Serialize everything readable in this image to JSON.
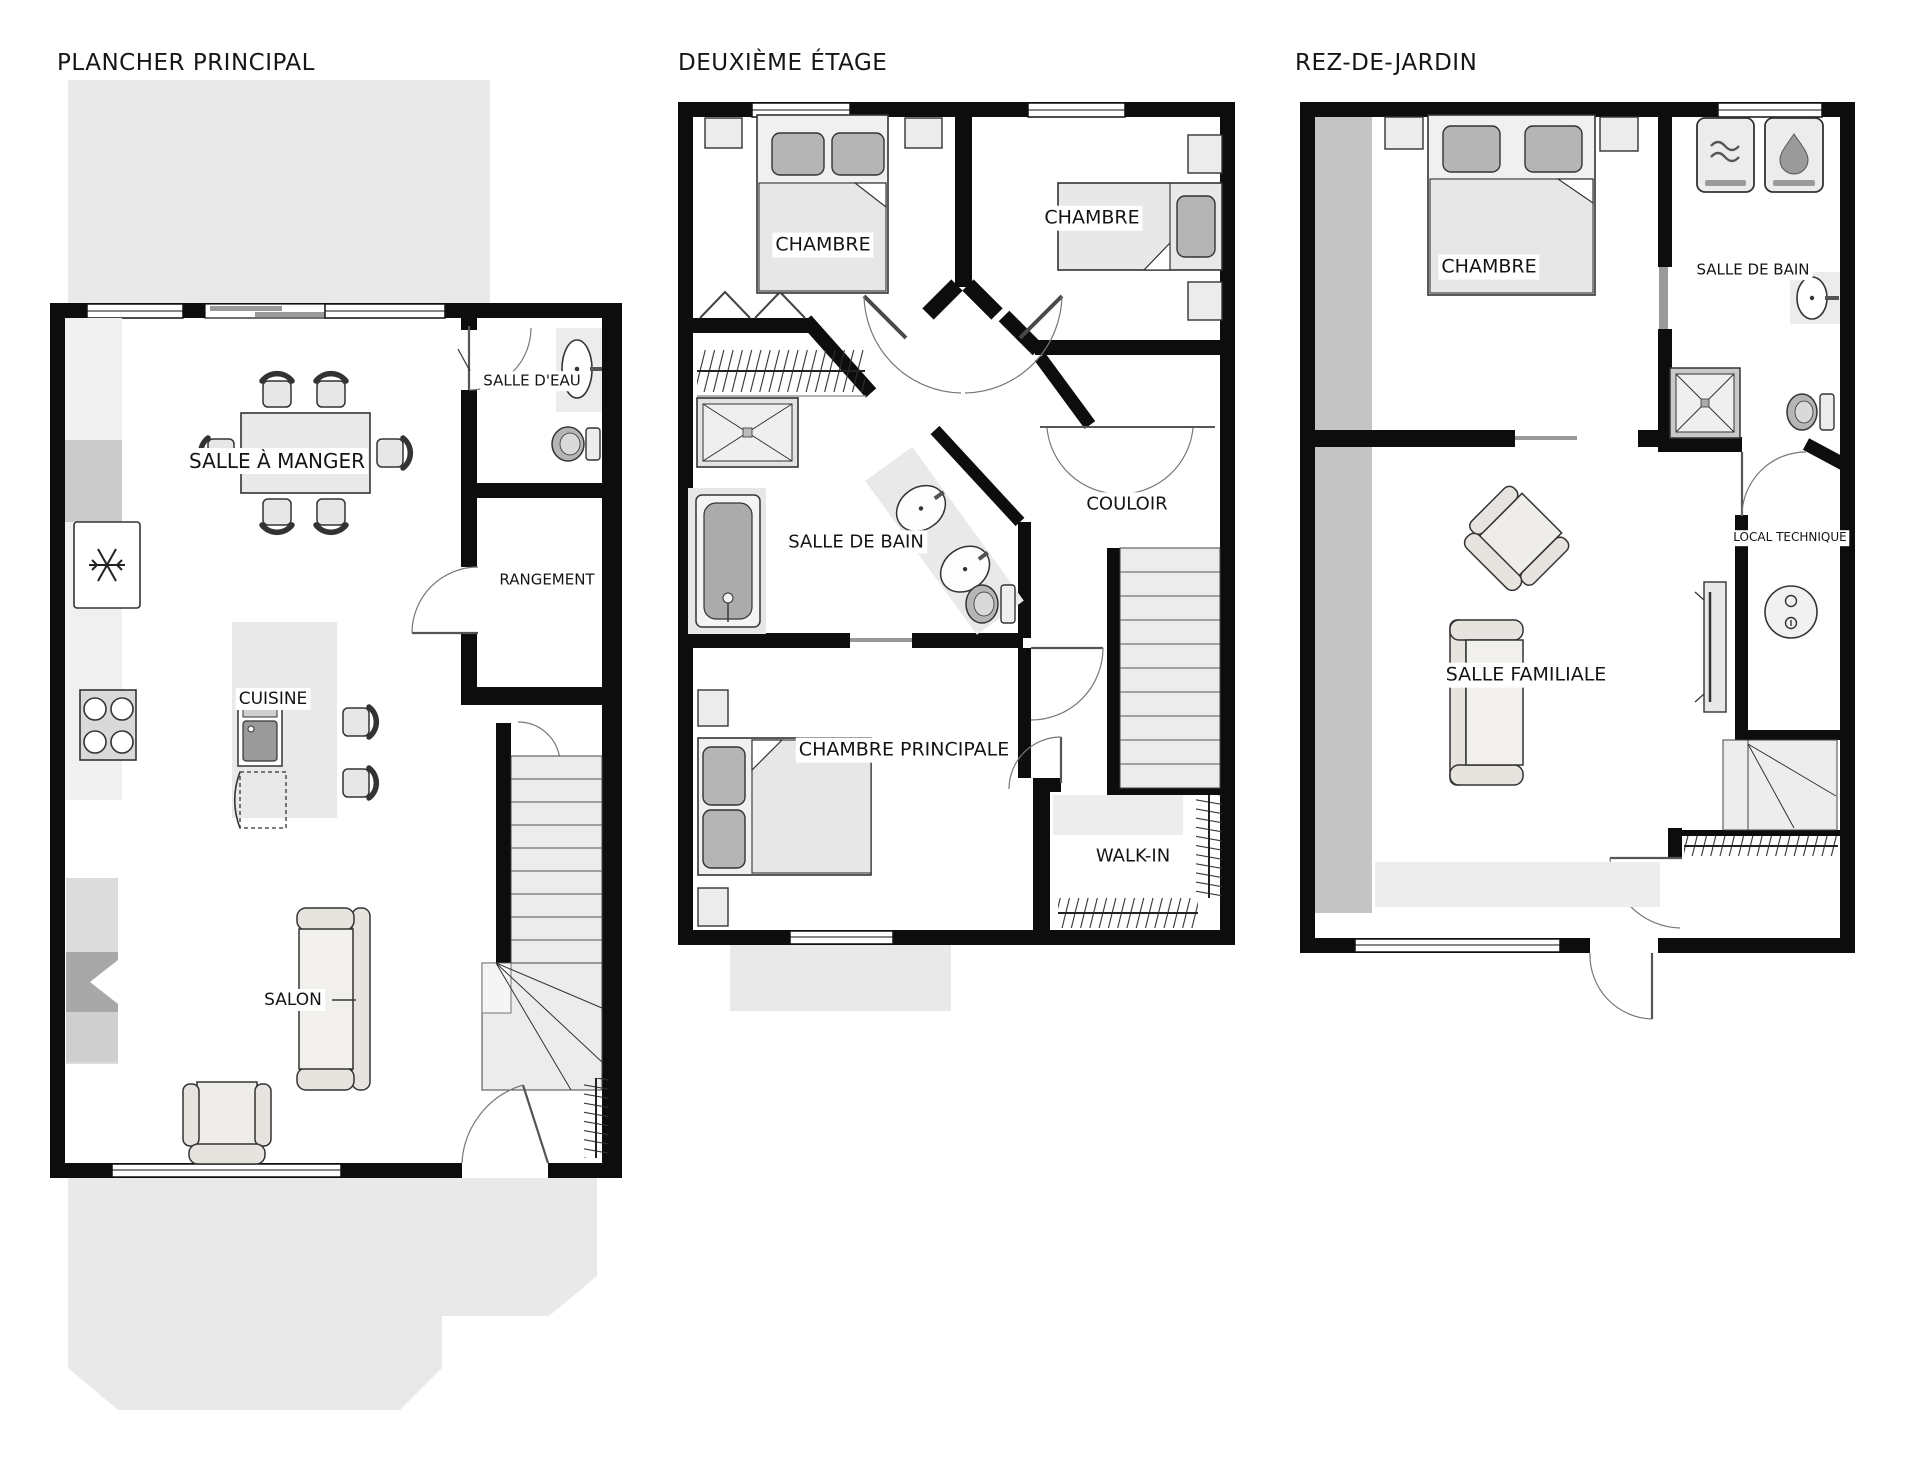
{
  "document": {
    "title": "Plans d'étage",
    "background": "#ffffff"
  },
  "colors": {
    "wall": "#0d0d0d",
    "floor": "#ffffff",
    "deck": "#e9e9e9",
    "party_wall": "#c4c4c4",
    "furniture": "#ececec",
    "soft_dark": "#b5b5b5",
    "label_bg": "#ffffff",
    "text": "#141414"
  },
  "icons": {
    "fridge": "snowflake-icon",
    "cooktop": "burners-icon",
    "kitchen_sink": "basin-icon",
    "washer": "waves-icon",
    "dryer": "droplet-icon",
    "shower": "x-cross-icon",
    "water_heater": "gauge-circles-icon"
  },
  "plans": [
    {
      "title": "PLANCHER PRINCIPAL",
      "rooms": [
        {
          "label": "SALLE À MANGER"
        },
        {
          "label": "SALLE D'EAU"
        },
        {
          "label": "RANGEMENT"
        },
        {
          "label": "CUISINE"
        },
        {
          "label": "SALON"
        }
      ]
    },
    {
      "title": "DEUXIÈME ÉTAGE",
      "rooms": [
        {
          "label": "CHAMBRE"
        },
        {
          "label": "CHAMBRE"
        },
        {
          "label": "SALLE DE BAIN"
        },
        {
          "label": "COULOIR"
        },
        {
          "label": "CHAMBRE PRINCIPALE"
        },
        {
          "label": "WALK-IN"
        }
      ]
    },
    {
      "title": "REZ-DE-JARDIN",
      "rooms": [
        {
          "label": "CHAMBRE"
        },
        {
          "label": "SALLE DE BAIN"
        },
        {
          "label": "LOCAL TECHNIQUE"
        },
        {
          "label": "SALLE FAMILIALE"
        }
      ]
    }
  ]
}
